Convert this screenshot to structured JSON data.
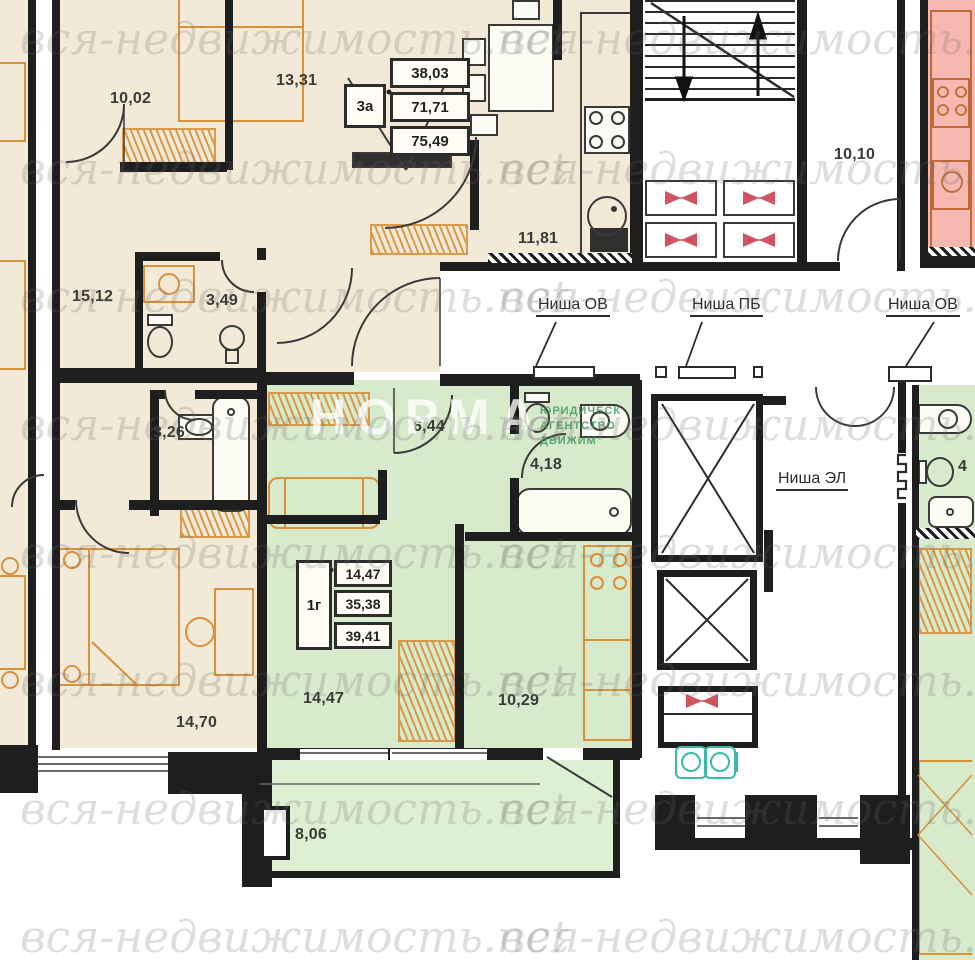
{
  "plan": {
    "watermark": {
      "text": "вся-недвижимость.net",
      "brand_big": "НОРМА",
      "brand_small_lines": [
        "ЮРИДИЧЕСК",
        "АГЕНТСТВО",
        "ДВИЖИМ"
      ]
    },
    "apartments": {
      "apt3a": {
        "type_label": "3а",
        "stamp_areas": [
          "38,03",
          "71,71",
          "75,49"
        ],
        "rooms": {
          "bedroom_top": "10,02",
          "corridor": "13,31",
          "kitchen": "11,81",
          "hall": "15,12",
          "bath_top": "3,49",
          "bath_bottom": "3,26",
          "bedroom_bottom": "14,70"
        }
      },
      "apt1g": {
        "type_label": "1г",
        "stamp_areas": [
          "14,47",
          "35,38",
          "39,41"
        ],
        "rooms": {
          "hall": "6,44",
          "bath": "4,18",
          "living": "14,47",
          "kitchen": "10,29",
          "balcony": "8,06"
        }
      },
      "apt_right": {
        "partial_label": "4"
      }
    },
    "common": {
      "lobby": "10,10",
      "niches": {
        "ov1": "Ниша ОВ",
        "pb": "Ниша ПБ",
        "ov2": "Ниша ОВ",
        "el": "Ниша ЭЛ"
      }
    }
  },
  "colors": {
    "beige": "#f2ead7",
    "green": "#d8eacc",
    "green_light": "#def0d4",
    "pink": "#f6b8b0",
    "wall": "#1e1e1e",
    "furniture_orange": "#d8913c",
    "fixture": "#3a3a3a",
    "fire_red": "#d05560",
    "teal": "#3cb8a8",
    "label": "#3a3a3a"
  }
}
